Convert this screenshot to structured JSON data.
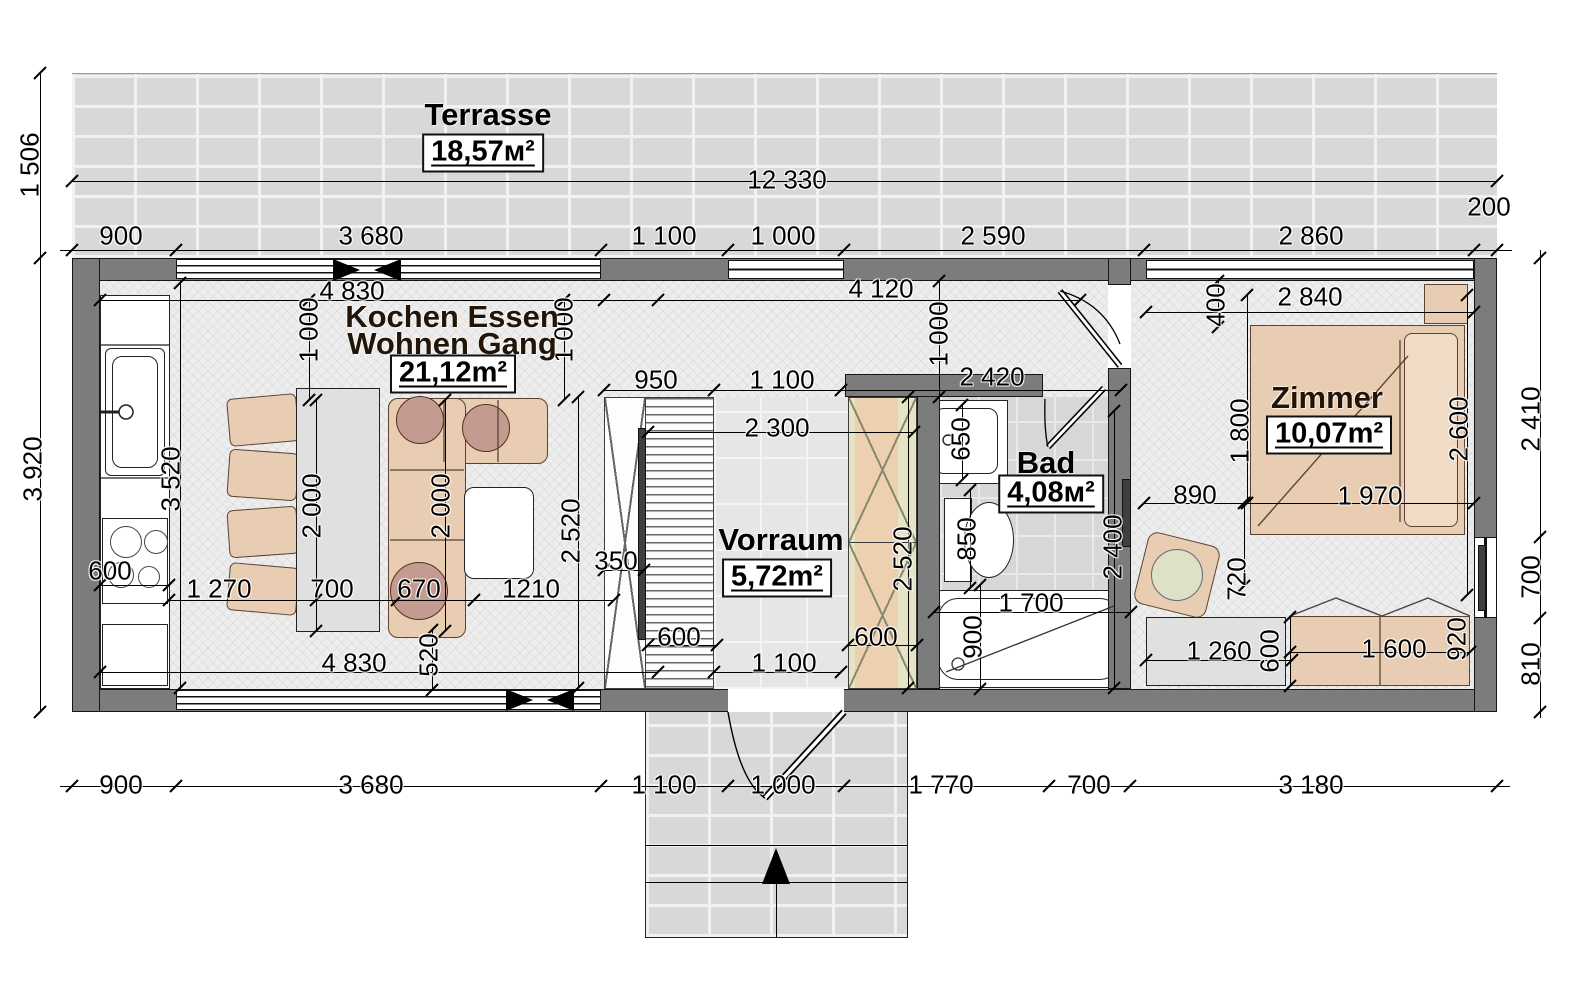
{
  "rooms": {
    "terrasse": {
      "name": "Terrasse",
      "area": "18,57м²"
    },
    "wohnen": {
      "name_line1": "Kochen Essen",
      "name_line2": "Wohnen Gang",
      "area": "21,12m²"
    },
    "vorraum": {
      "name": "Vorraum",
      "area": "5,72m²"
    },
    "bad": {
      "name": "Bad",
      "area": "4,08м²"
    },
    "zimmer": {
      "name": "Zimmer",
      "area": "10,07m²"
    }
  },
  "colors": {
    "wall": "#7c7c7c",
    "furniture": "#e8cdb3",
    "accent_green": "#e7e3c5",
    "cushion": "#c49b90"
  },
  "units": "mm",
  "dimensions": [
    {
      "t": "1 506",
      "x": 30,
      "y": 165,
      "v": 1
    },
    {
      "t": "12 330",
      "x": 787,
      "y": 180
    },
    {
      "t": "900",
      "x": 121,
      "y": 236
    },
    {
      "t": "3 680",
      "x": 371,
      "y": 236
    },
    {
      "t": "1 100",
      "x": 664,
      "y": 236
    },
    {
      "t": "1 000",
      "x": 783,
      "y": 236
    },
    {
      "t": "2 590",
      "x": 993,
      "y": 236
    },
    {
      "t": "2 860",
      "x": 1311,
      "y": 236
    },
    {
      "t": "200",
      "x": 1489,
      "y": 207
    },
    {
      "t": "3 920",
      "x": 33,
      "y": 469,
      "v": 1
    },
    {
      "t": "900",
      "x": 121,
      "y": 785
    },
    {
      "t": "3 680",
      "x": 371,
      "y": 785
    },
    {
      "t": "1 100",
      "x": 664,
      "y": 785
    },
    {
      "t": "1 000",
      "x": 783,
      "y": 785
    },
    {
      "t": "1 770",
      "x": 941,
      "y": 785
    },
    {
      "t": "700",
      "x": 1089,
      "y": 785
    },
    {
      "t": "3 180",
      "x": 1311,
      "y": 785
    },
    {
      "t": "2 410",
      "x": 1531,
      "y": 419,
      "v": 1
    },
    {
      "t": "700",
      "x": 1531,
      "y": 577,
      "v": 1
    },
    {
      "t": "810",
      "x": 1531,
      "y": 664,
      "v": 1
    },
    {
      "t": "4 830",
      "x": 352,
      "y": 291
    },
    {
      "t": "1 000",
      "x": 309,
      "y": 330,
      "v": 1
    },
    {
      "t": "1 000",
      "x": 564,
      "y": 330,
      "v": 1
    },
    {
      "t": "4 120",
      "x": 881,
      "y": 289
    },
    {
      "t": "1 000",
      "x": 939,
      "y": 334,
      "v": 1
    },
    {
      "t": "2 840",
      "x": 1310,
      "y": 297
    },
    {
      "t": "400",
      "x": 1216,
      "y": 305,
      "v": 1
    },
    {
      "t": "950",
      "x": 656,
      "y": 380
    },
    {
      "t": "1 100",
      "x": 782,
      "y": 380
    },
    {
      "t": "2 420",
      "x": 992,
      "y": 377
    },
    {
      "t": "2 300",
      "x": 777,
      "y": 428
    },
    {
      "t": "3 520",
      "x": 171,
      "y": 479,
      "v": 1
    },
    {
      "t": "650",
      "x": 961,
      "y": 439,
      "v": 1
    },
    {
      "t": "1 800",
      "x": 1240,
      "y": 431,
      "v": 1
    },
    {
      "t": "2 000",
      "x": 312,
      "y": 506,
      "v": 1
    },
    {
      "t": "2 000",
      "x": 441,
      "y": 506,
      "v": 1
    },
    {
      "t": "2 520",
      "x": 571,
      "y": 531,
      "v": 1
    },
    {
      "t": "850",
      "x": 967,
      "y": 539,
      "v": 1
    },
    {
      "t": "2 400",
      "x": 1113,
      "y": 547,
      "v": 1
    },
    {
      "t": "890",
      "x": 1195,
      "y": 495
    },
    {
      "t": "1 970",
      "x": 1370,
      "y": 496
    },
    {
      "t": "2 600",
      "x": 1459,
      "y": 429,
      "v": 1
    },
    {
      "t": "600",
      "x": 110,
      "y": 571
    },
    {
      "t": "1 270",
      "x": 219,
      "y": 589
    },
    {
      "t": "700",
      "x": 332,
      "y": 589
    },
    {
      "t": "670",
      "x": 419,
      "y": 589
    },
    {
      "t": "1210",
      "x": 531,
      "y": 589
    },
    {
      "t": "350",
      "x": 616,
      "y": 561
    },
    {
      "t": "520",
      "x": 429,
      "y": 655,
      "v": 1
    },
    {
      "t": "4 830",
      "x": 354,
      "y": 663
    },
    {
      "t": "600",
      "x": 679,
      "y": 637
    },
    {
      "t": "1 100",
      "x": 784,
      "y": 663
    },
    {
      "t": "600",
      "x": 876,
      "y": 637
    },
    {
      "t": "2 520",
      "x": 903,
      "y": 559,
      "v": 1
    },
    {
      "t": "1 700",
      "x": 1031,
      "y": 603
    },
    {
      "t": "900",
      "x": 973,
      "y": 637,
      "v": 1
    },
    {
      "t": "720",
      "x": 1237,
      "y": 579,
      "v": 1
    },
    {
      "t": "1 260",
      "x": 1219,
      "y": 651
    },
    {
      "t": "600",
      "x": 1270,
      "y": 651,
      "v": 1
    },
    {
      "t": "1 600",
      "x": 1394,
      "y": 649
    },
    {
      "t": "920",
      "x": 1457,
      "y": 639,
      "v": 1
    }
  ],
  "lines": {
    "h": [
      [
        60,
        250,
        1452
      ],
      [
        72,
        181,
        1425
      ],
      [
        60,
        786,
        1450
      ],
      [
        100,
        300,
        558
      ],
      [
        604,
        300,
        476
      ],
      [
        1146,
        312,
        328
      ],
      [
        604,
        390,
        517
      ],
      [
        648,
        432,
        266
      ],
      [
        1144,
        503,
        330
      ],
      [
        169,
        600,
        445
      ],
      [
        100,
        672,
        558
      ],
      [
        604,
        570,
        40
      ],
      [
        648,
        645,
        69
      ],
      [
        714,
        672,
        127
      ],
      [
        848,
        645,
        69
      ],
      [
        934,
        612,
        197
      ],
      [
        1146,
        660,
        146
      ],
      [
        1290,
        652,
        180
      ],
      [
        100,
        585,
        69
      ],
      [
        645,
        845,
        263
      ],
      [
        645,
        882,
        263
      ]
    ],
    "v": [
      [
        40,
        73,
        639
      ],
      [
        1540,
        250,
        468
      ],
      [
        180,
        283,
        405
      ],
      [
        309,
        300,
        100
      ],
      [
        564,
        300,
        100
      ],
      [
        939,
        281,
        116
      ],
      [
        1218,
        281,
        46
      ],
      [
        316,
        400,
        231
      ],
      [
        445,
        400,
        231
      ],
      [
        578,
        397,
        291
      ],
      [
        908,
        397,
        291
      ],
      [
        962,
        405,
        75
      ],
      [
        970,
        490,
        98
      ],
      [
        1114,
        411,
        277
      ],
      [
        1247,
        295,
        208
      ],
      [
        1467,
        295,
        300
      ],
      [
        1244,
        503,
        83
      ],
      [
        432,
        630,
        60
      ],
      [
        980,
        585,
        104
      ],
      [
        1290,
        617,
        69
      ],
      [
        776,
        882,
        56
      ]
    ]
  },
  "ticks": [
    [
      72,
      250
    ],
    [
      176,
      250
    ],
    [
      601,
      250
    ],
    [
      728,
      250
    ],
    [
      844,
      250
    ],
    [
      1144,
      250
    ],
    [
      1474,
      250
    ],
    [
      1497,
      250
    ],
    [
      72,
      181
    ],
    [
      1497,
      181
    ],
    [
      72,
      786
    ],
    [
      176,
      786
    ],
    [
      601,
      786
    ],
    [
      728,
      786
    ],
    [
      844,
      786
    ],
    [
      1049,
      786
    ],
    [
      1130,
      786
    ],
    [
      1497,
      786
    ],
    [
      40,
      73
    ],
    [
      40,
      258
    ],
    [
      40,
      712
    ],
    [
      1540,
      258
    ],
    [
      1540,
      537
    ],
    [
      1540,
      618
    ],
    [
      1540,
      712
    ],
    [
      100,
      300
    ],
    [
      658,
      300
    ],
    [
      604,
      300
    ],
    [
      1080,
      300
    ],
    [
      1146,
      312
    ],
    [
      1474,
      312
    ],
    [
      604,
      390
    ],
    [
      714,
      390
    ],
    [
      841,
      390
    ],
    [
      1121,
      390
    ],
    [
      648,
      432
    ],
    [
      914,
      432
    ],
    [
      180,
      283
    ],
    [
      180,
      688
    ],
    [
      316,
      400
    ],
    [
      316,
      631
    ],
    [
      445,
      400
    ],
    [
      445,
      631
    ],
    [
      578,
      397
    ],
    [
      578,
      688
    ],
    [
      908,
      397
    ],
    [
      908,
      688
    ],
    [
      1114,
      411
    ],
    [
      1114,
      688
    ],
    [
      1247,
      295
    ],
    [
      1247,
      503
    ],
    [
      1144,
      503
    ],
    [
      1247,
      503
    ],
    [
      1474,
      503
    ],
    [
      1467,
      295
    ],
    [
      1467,
      595
    ],
    [
      169,
      600
    ],
    [
      316,
      600
    ],
    [
      397,
      600
    ],
    [
      474,
      600
    ],
    [
      614,
      600
    ],
    [
      100,
      672
    ],
    [
      658,
      672
    ],
    [
      604,
      570
    ],
    [
      644,
      570
    ],
    [
      648,
      645
    ],
    [
      717,
      645
    ],
    [
      714,
      672
    ],
    [
      841,
      672
    ],
    [
      848,
      645
    ],
    [
      917,
      645
    ],
    [
      934,
      612
    ],
    [
      1131,
      612
    ],
    [
      980,
      585
    ],
    [
      980,
      689
    ],
    [
      1146,
      660
    ],
    [
      1292,
      660
    ],
    [
      1290,
      652
    ],
    [
      1470,
      652
    ],
    [
      100,
      585
    ],
    [
      169,
      585
    ],
    [
      432,
      630
    ],
    [
      432,
      690
    ],
    [
      962,
      405
    ],
    [
      962,
      480
    ],
    [
      970,
      490
    ],
    [
      970,
      588
    ],
    [
      1244,
      503
    ],
    [
      1244,
      586
    ],
    [
      1290,
      617
    ],
    [
      1290,
      686
    ],
    [
      309,
      300
    ],
    [
      309,
      400
    ],
    [
      564,
      300
    ],
    [
      564,
      400
    ],
    [
      939,
      281
    ],
    [
      939,
      397
    ],
    [
      1218,
      281
    ],
    [
      1218,
      327
    ]
  ]
}
